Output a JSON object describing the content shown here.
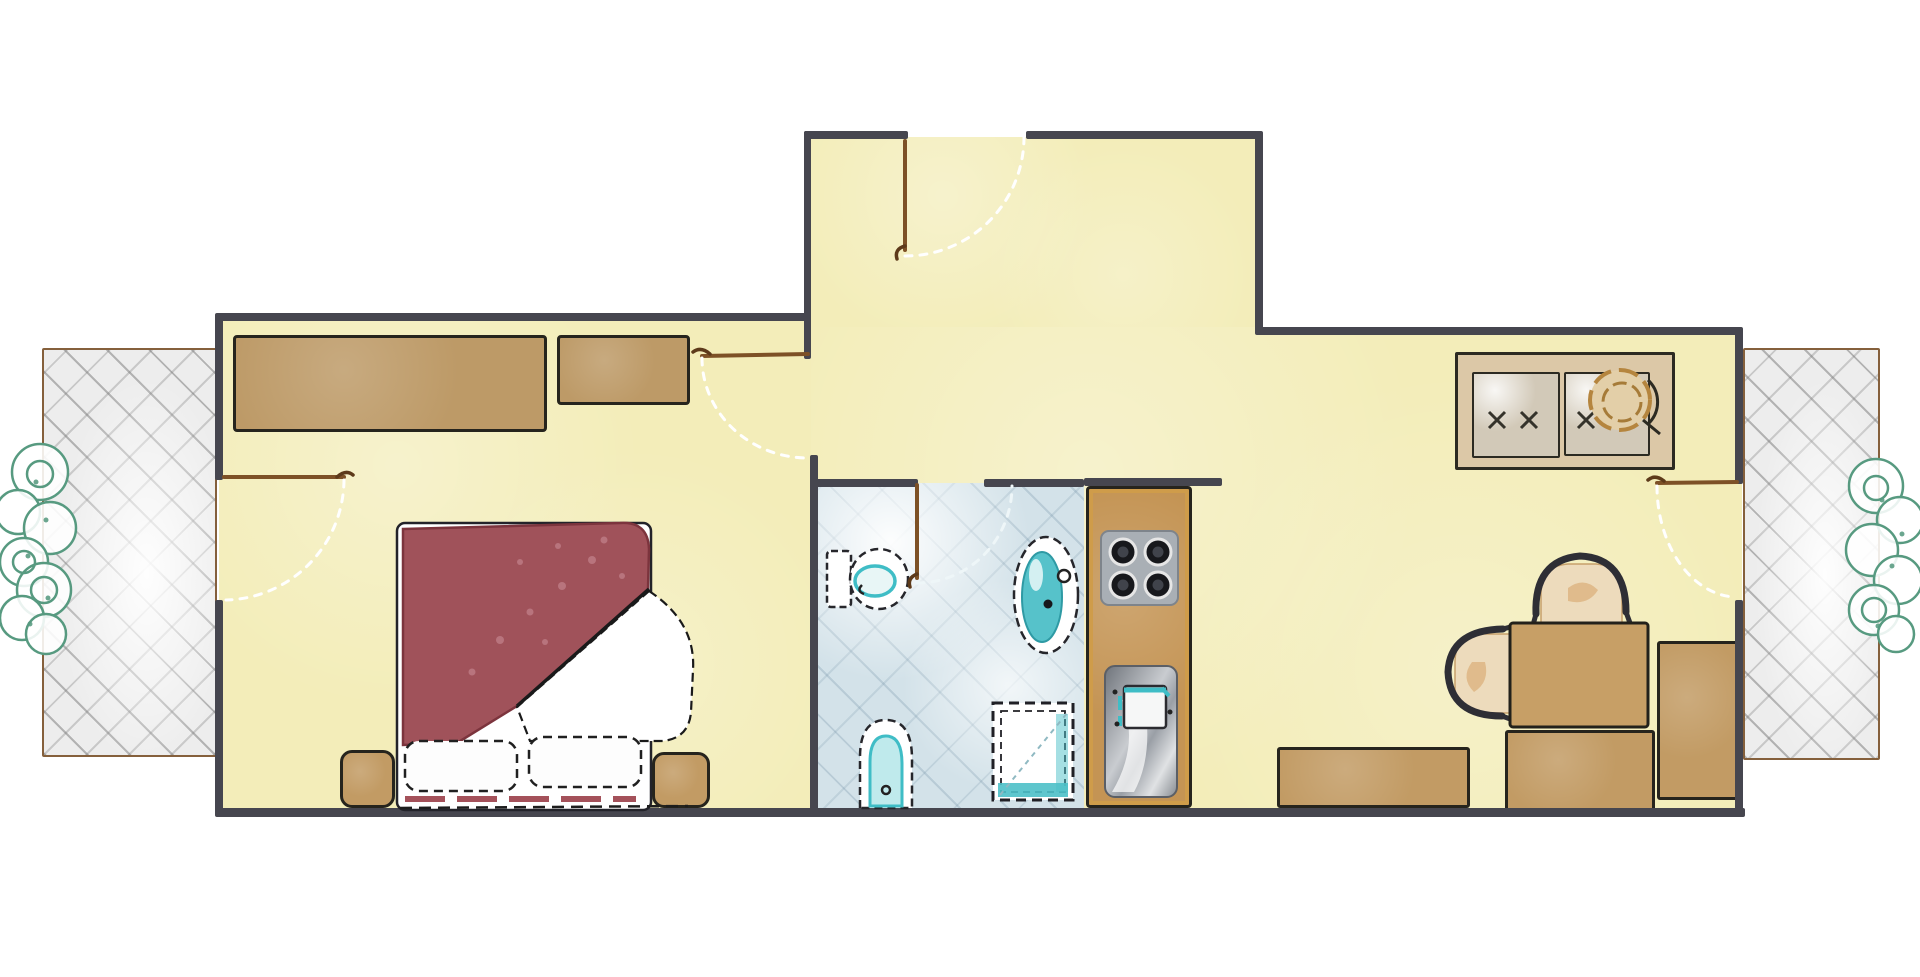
{
  "plan_title": "Apartment floor plan (hand-drawn watercolor style)",
  "palette": {
    "outside": "#ffffff",
    "floor_yellow": "#f3edb9",
    "wall_dark": "#46464f",
    "furniture_tan": "#c29b64",
    "kitchen_tan": "#c49454",
    "blanket_red": "#a0525a",
    "blanket_edge": "#7c343d",
    "linen_white": "#ffffff",
    "bath_floor_blue": "#d3e2e9",
    "water_teal": "#3fbdc6",
    "cooktop_gray": "#a9afb5",
    "burner_black": "#17181c",
    "balcony_gray": "#ededed",
    "shrub_green": "#579a80",
    "door_brown": "#7d5126",
    "sideboard_tan": "#dcc8a7"
  },
  "rooms": [
    {
      "id": "bedroom",
      "label": "Bedroom"
    },
    {
      "id": "bathroom",
      "label": "Bathroom"
    },
    {
      "id": "entry-vestibule",
      "label": "Entry vestibule"
    },
    {
      "id": "kitchenette",
      "label": "Kitchenette column"
    },
    {
      "id": "living-dining",
      "label": "Living / dining area"
    },
    {
      "id": "balcony-left",
      "label": "Left balcony terrace"
    },
    {
      "id": "balcony-right",
      "label": "Right balcony terrace"
    }
  ],
  "furniture": {
    "bedroom": [
      {
        "id": "wardrobe-large",
        "label": "Large wardrobe"
      },
      {
        "id": "wardrobe-small",
        "label": "Small wardrobe"
      },
      {
        "id": "double-bed",
        "label": "Double bed with red blanket and folded white sheet"
      },
      {
        "id": "pillow-left",
        "label": "Pillow"
      },
      {
        "id": "pillow-right",
        "label": "Pillow"
      },
      {
        "id": "nightstand-left",
        "label": "Nightstand"
      },
      {
        "id": "nightstand-right",
        "label": "Nightstand"
      }
    ],
    "bathroom": [
      {
        "id": "toilet",
        "label": "Toilet"
      },
      {
        "id": "bidet",
        "label": "Bidet"
      },
      {
        "id": "washbasin",
        "label": "Washbasin"
      },
      {
        "id": "shower",
        "label": "Shower tray"
      }
    ],
    "kitchenette": [
      {
        "id": "cooktop",
        "label": "Four-burner cooktop"
      },
      {
        "id": "kitchen-sink",
        "label": "Kitchen sink with drainboard"
      }
    ],
    "living_dining": [
      {
        "id": "sideboard",
        "label": "Sideboard cabinet with basin bowl and X handles"
      },
      {
        "id": "dining-table",
        "label": "Square dining table"
      },
      {
        "id": "chair-top",
        "label": "Chair"
      },
      {
        "id": "chair-left",
        "label": "Chair"
      },
      {
        "id": "bench-bottom",
        "label": "Bench / counter below table"
      },
      {
        "id": "bench-right",
        "label": "Bench / counter on right wall"
      },
      {
        "id": "counter-bottom",
        "label": "Low counter on bottom wall"
      }
    ],
    "balconies": [
      {
        "id": "shrubs-left",
        "label": "Shrub planting, 7 bushes"
      },
      {
        "id": "shrubs-right",
        "label": "Shrub planting, 6 bushes"
      }
    ]
  },
  "doors": [
    {
      "id": "entry-door",
      "label": "Entry door with swing arc"
    },
    {
      "id": "bedroom-door",
      "label": "Bedroom door with swing arc"
    },
    {
      "id": "bathroom-door",
      "label": "Bathroom door with swing arc"
    },
    {
      "id": "balcony-door-left",
      "label": "Balcony door (bedroom) with swing arc"
    },
    {
      "id": "balcony-door-right",
      "label": "Balcony door (living area) with swing arc"
    }
  ]
}
